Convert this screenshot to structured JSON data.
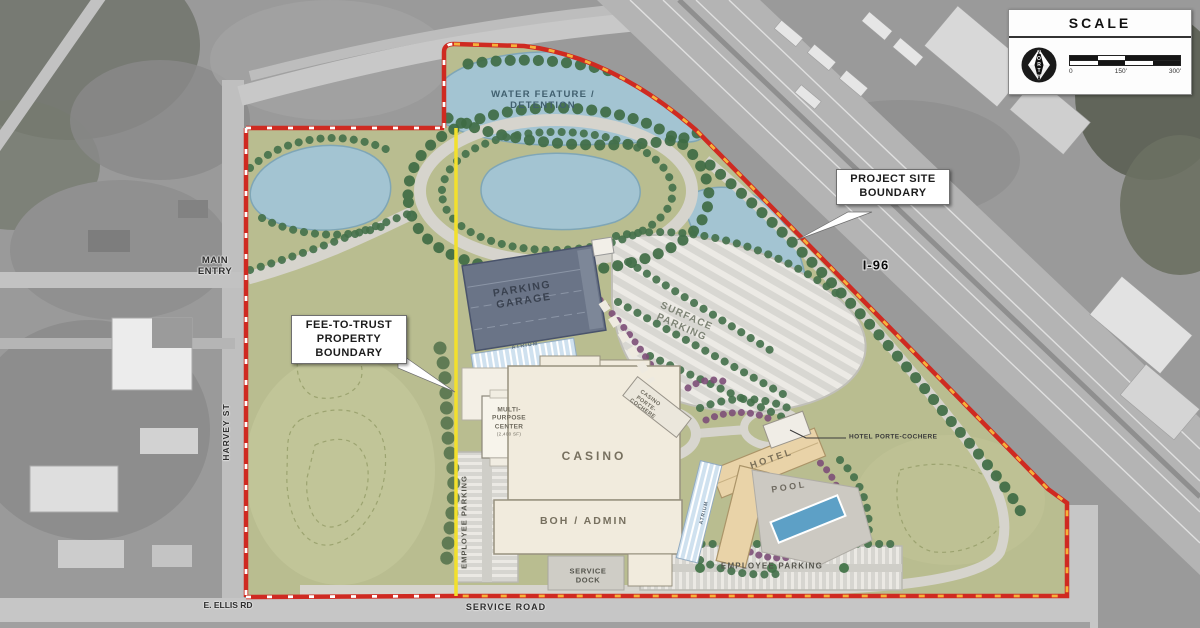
{
  "colors": {
    "boundary_red": "#cf2a21",
    "boundary_dash_yellow": "#f6b23a",
    "boundary_dash_white": "#ffffff",
    "fee_to_trust_yellow": "#f2e02c",
    "pond_blue": "#a3c4d2",
    "site_green": "#b9bd90",
    "garage_roof": "#6a7487",
    "casino_roof": "#f1ebdd",
    "hotel_roof": "#e9d3a8",
    "pool_blue": "#5da0c6",
    "aerial_gray": "#9a9a9a"
  },
  "scale_panel": {
    "title": "SCALE",
    "north_label": "NORTH",
    "ticks": [
      "0",
      "150'",
      "300'"
    ]
  },
  "callouts": {
    "project_site_boundary": {
      "line1": "PROJECT SITE",
      "line2": "BOUNDARY"
    },
    "fee_to_trust": {
      "line1": "FEE-TO-TRUST",
      "line2": "PROPERTY",
      "line3": "BOUNDARY"
    }
  },
  "roads": {
    "i96": "I-96",
    "harvey_st": "HARVEY ST",
    "main_entry_line1": "MAIN",
    "main_entry_line2": "ENTRY",
    "e_ellis_rd": "E. ELLIS RD",
    "service_road": "SERVICE ROAD"
  },
  "site": {
    "water_feature_line1": "WATER FEATURE /",
    "water_feature_line2": "DETENTION",
    "parking_garage_line1": "PARKING",
    "parking_garage_line2": "GARAGE",
    "surface_parking_line1": "SURFACE",
    "surface_parking_line2": "PARKING",
    "casino": "CASINO",
    "boh_admin": "BOH / ADMIN",
    "multi_purpose_line1": "MULTI-",
    "multi_purpose_line2": "PURPOSE",
    "multi_purpose_line3": "CENTER",
    "multi_purpose_note": "(2,400 SF)",
    "casino_pc_line1": "CASINO",
    "casino_pc_line2": "PORTE-",
    "casino_pc_line3": "COCHERE",
    "hotel": "HOTEL",
    "pool": "POOL",
    "hotel_porte_cochere": "HOTEL PORTE-COCHERE",
    "atrium_casino": "ATRIUM",
    "atrium_hotel": "ATRIUM",
    "employee_parking_west": "EMPLOYEE PARKING",
    "employee_parking_south": "EMPLOYEE PARKING",
    "service_dock_line1": "SERVICE",
    "service_dock_line2": "DOCK"
  }
}
